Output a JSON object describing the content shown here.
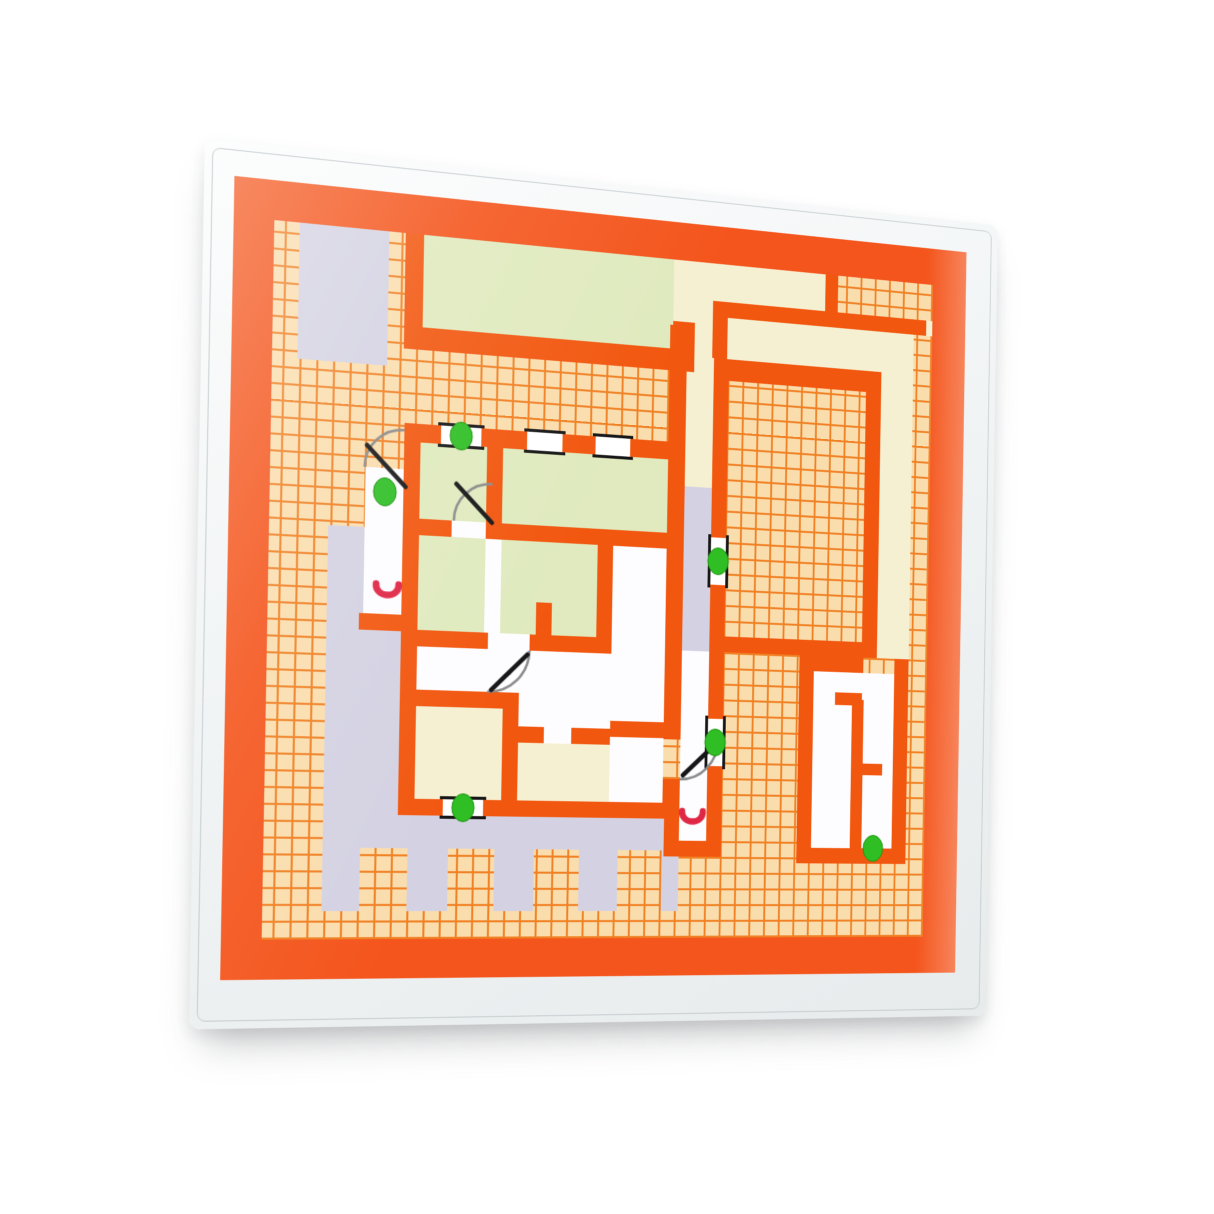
{
  "scene": {
    "subject": "floor-plan-card-in-clear-plastic-sleeve",
    "background": "#ffffff"
  },
  "palette": {
    "border_orange": "#F4551C",
    "wall_orange": "#F2570F",
    "grid_bg": "#FADDAD",
    "grid_line": "#F08124",
    "cream": "#F6F0D2",
    "green_room": "#E0EABE",
    "lavender": "#D4D2E2",
    "white_room": "#FDFDFF",
    "marker_green": "#2FBF25",
    "marker_red": "#E02645",
    "window_black": "#161616",
    "door_arc_gray": "#8A8A8A",
    "sleeve_edge": "#E7EBEC"
  },
  "floorplan": {
    "green_dot_count": 6,
    "green_dots": [
      {
        "x": 222,
        "y": 231
      },
      {
        "x": 148,
        "y": 290
      },
      {
        "x": 489,
        "y": 340
      },
      {
        "x": 489,
        "y": 524
      },
      {
        "x": 230,
        "y": 594
      },
      {
        "x": 664,
        "y": 630
      }
    ],
    "red_handles": [
      {
        "x": 152,
        "y": 385
      },
      {
        "x": 466,
        "y": 600
      }
    ],
    "windows": [
      {
        "x": 202,
        "y": 222,
        "w": 40,
        "h": 18,
        "o": "h"
      },
      {
        "x": 288,
        "y": 222,
        "w": 36,
        "h": 18,
        "o": "h"
      },
      {
        "x": 358,
        "y": 222,
        "w": 36,
        "h": 18,
        "o": "h"
      },
      {
        "x": 210,
        "y": 586,
        "w": 40,
        "h": 16,
        "o": "h"
      },
      {
        "x": 481,
        "y": 316,
        "w": 16,
        "h": 48,
        "o": "v"
      },
      {
        "x": 481,
        "y": 500,
        "w": 16,
        "h": 48,
        "o": "v"
      }
    ],
    "doors": [
      {
        "d": "M166,229 A38,38 0 0 0 128,267",
        "leaf": [
          130,
          246,
          168,
          284
        ]
      },
      {
        "d": "M254,276 A38,38 0 0 0 216,314",
        "leaf": [
          218,
          278,
          254,
          314
        ]
      },
      {
        "d": "M294,438 A42,42 0 0 1 252,480",
        "leaf": [
          256,
          478,
          292,
          442
        ]
      },
      {
        "d": "M452,562 A40,40 0 0 0 492,522",
        "leaf": [
          455,
          558,
          489,
          526
        ]
      }
    ],
    "terrace_notches": [
      {
        "x": 130,
        "y": 634,
        "w": 46,
        "h": 61
      },
      {
        "x": 216,
        "y": 634,
        "w": 46,
        "h": 61
      },
      {
        "x": 302,
        "y": 634,
        "w": 46,
        "h": 61
      },
      {
        "x": 388,
        "y": 634,
        "w": 46,
        "h": 61
      }
    ]
  }
}
